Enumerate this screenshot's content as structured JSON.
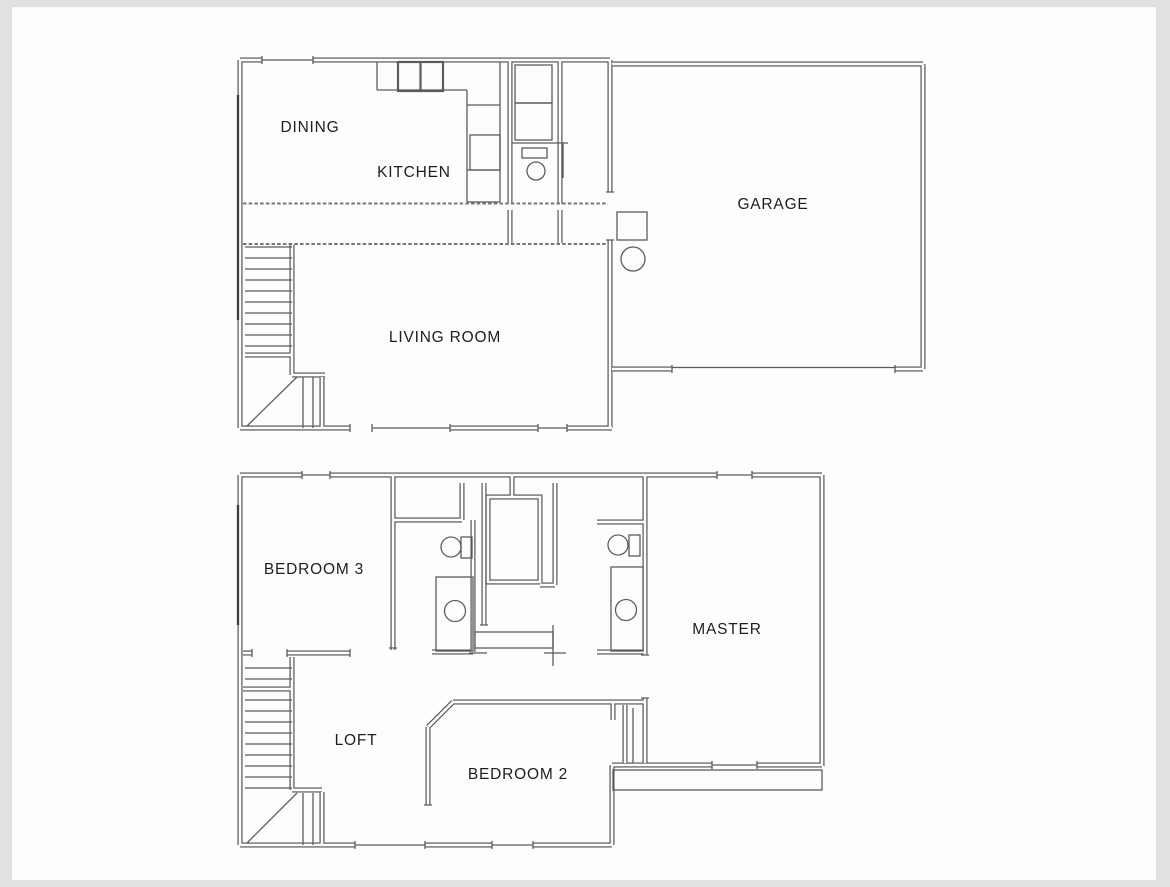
{
  "colors": {
    "paper": "#fdfdfb",
    "photo_border": "#e1e1e4",
    "wall_line": "#4d4d4d",
    "fixture_line": "#5c5c5c",
    "label_text": "#1e1e1e"
  },
  "floor1": {
    "name": "first-floor-plan",
    "rooms": [
      {
        "label": "DINING"
      },
      {
        "label": "KITCHEN"
      },
      {
        "label": "GARAGE"
      },
      {
        "label": "LIVING ROOM"
      }
    ]
  },
  "floor2": {
    "name": "second-floor-plan",
    "rooms": [
      {
        "label": "BEDROOM 3"
      },
      {
        "label": "MASTER"
      },
      {
        "label": "LOFT"
      },
      {
        "label": "BEDROOM 2"
      }
    ]
  }
}
